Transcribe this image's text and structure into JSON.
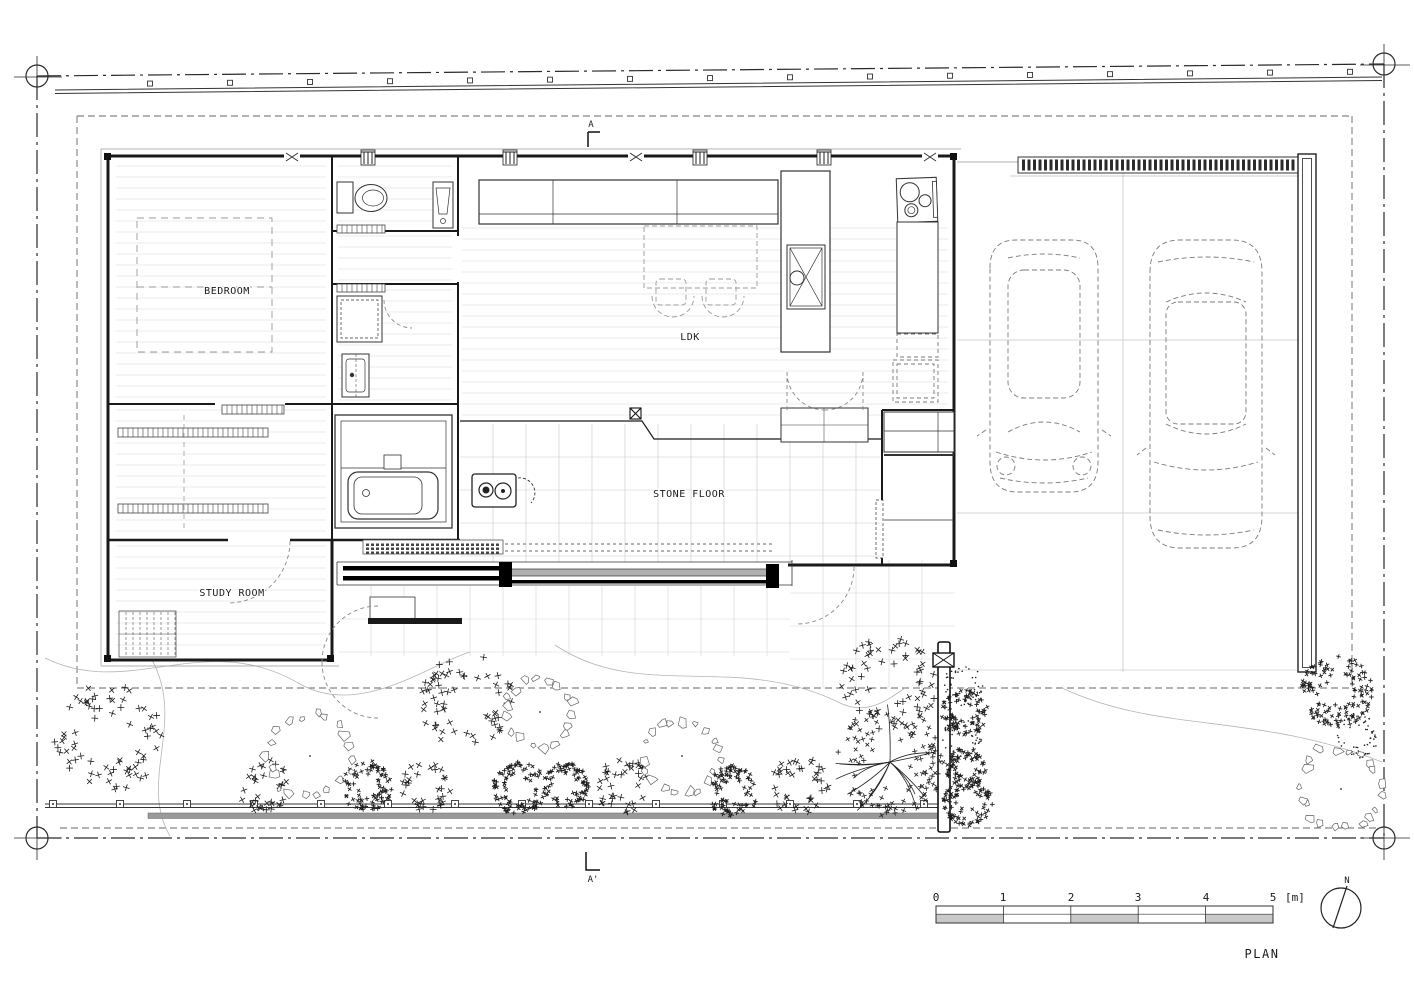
{
  "drawing": {
    "title": "PLAN",
    "rooms": [
      {
        "name": "bedroom",
        "label": "BEDROOM"
      },
      {
        "name": "ldk",
        "label": "LDK"
      },
      {
        "name": "stone-floor",
        "label": "STONE FLOOR"
      },
      {
        "name": "study-room",
        "label": "STUDY ROOM"
      }
    ],
    "section_marker_top": "A",
    "section_marker_bottom": "A'",
    "north_label": "N",
    "scale_bar": {
      "ticks": [
        "0",
        "1",
        "2",
        "3",
        "4",
        "5"
      ],
      "unit": "[m]"
    }
  }
}
